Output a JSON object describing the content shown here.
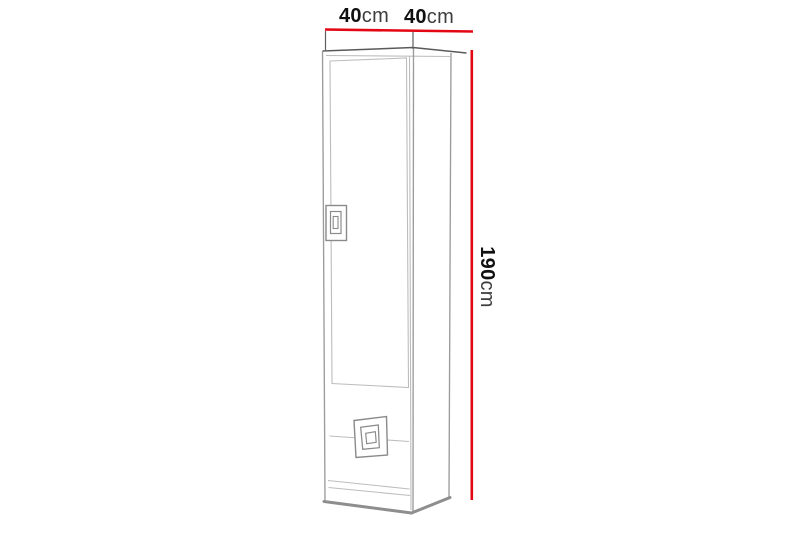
{
  "diagram": {
    "type": "furniture-dimension-drawing",
    "subject": "tall narrow cabinet with one door and bottom drawer front, three-quarter line view",
    "labels": {
      "width": {
        "value": "40",
        "unit": "cm",
        "text": "40cm",
        "orientation": "horizontal",
        "position": "top-left-span"
      },
      "depth": {
        "value": "40",
        "unit": "cm",
        "text": "40cm",
        "orientation": "horizontal",
        "position": "top-right-span"
      },
      "height": {
        "value": "190",
        "unit": "cm",
        "text": "190cm",
        "orientation": "vertical-rotated-90deg",
        "position": "right-side"
      }
    },
    "colors": {
      "dimension_line": "#e30613",
      "outline_dark": "#5a5a5a",
      "outline_light": "#9b9b9b",
      "background": "#ffffff"
    }
  }
}
